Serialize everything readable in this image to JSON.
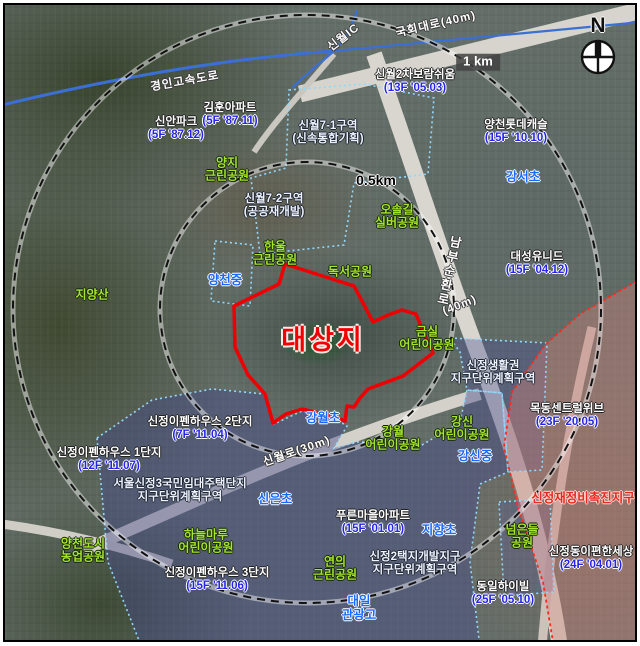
{
  "map": {
    "compass": {
      "north": "N"
    },
    "target": {
      "label": "대상지",
      "x": 318,
      "y": 335,
      "boundary_color": "#ee0000",
      "boundary_points": "283,262 352,284 371,320 386,313 400,308 414,312 422,332 431,351 401,374 366,387 358,396 352,405 345,404 343,419 334,415 321,412 300,407 284,412 271,421 263,392 256,384 246,373 233,345 232,304 277,282"
    },
    "rings": {
      "center": {
        "x": 305,
        "y": 307
      },
      "items": [
        {
          "label": "0.5km",
          "radius_px": 147,
          "label_x": 371,
          "label_y": 176,
          "style": "plain"
        },
        {
          "label": "1 km",
          "radius_px": 294,
          "label_x": 473,
          "label_y": 57,
          "style": "boxed"
        }
      ]
    },
    "colors": {
      "target_outline": "#ee0000",
      "park_text": "#a4e62e",
      "school_text": "#1769ff",
      "apartment_info_text": "#2424ea",
      "renewal_zone_text": "#e8281e",
      "district_boundary": "#8fd8ff",
      "renewal_boundary": "#ff2a1a"
    },
    "labels": [
      {
        "type": "road",
        "x": 180,
        "y": 77,
        "rot": -10,
        "lines": [
          "경인고속도로"
        ]
      },
      {
        "type": "road",
        "x": 339,
        "y": 33,
        "rot": -38,
        "lines": [
          "신월IC"
        ]
      },
      {
        "type": "road",
        "x": 431,
        "y": 20,
        "rot": -13,
        "lines": [
          "국회대로(40m)"
        ]
      },
      {
        "type": "road-v",
        "x": 443,
        "y": 266,
        "rot": 12,
        "lines": [
          "남부순환로"
        ]
      },
      {
        "type": "road",
        "x": 455,
        "y": 301,
        "rot": -22,
        "lines": [
          "(40m)"
        ]
      },
      {
        "type": "road",
        "x": 292,
        "y": 447,
        "rot": -19,
        "lines": [
          "신월로(30m)"
        ]
      },
      {
        "type": "school",
        "x": 220,
        "y": 275,
        "lines": [
          "양천중"
        ]
      },
      {
        "type": "school",
        "x": 518,
        "y": 172,
        "lines": [
          "강서초"
        ]
      },
      {
        "type": "school",
        "x": 318,
        "y": 413,
        "lines": [
          "강월초"
        ]
      },
      {
        "type": "school",
        "x": 270,
        "y": 494,
        "lines": [
          "신은초"
        ]
      },
      {
        "type": "school",
        "x": 434,
        "y": 525,
        "lines": [
          "지향초"
        ]
      },
      {
        "type": "school",
        "x": 470,
        "y": 451,
        "lines": [
          "강신중"
        ]
      },
      {
        "type": "school",
        "x": 354,
        "y": 603,
        "lines": [
          "대일",
          "관광고"
        ]
      },
      {
        "type": "park",
        "x": 222,
        "y": 165,
        "lines": [
          "양지",
          "근린공원"
        ]
      },
      {
        "type": "park",
        "x": 392,
        "y": 212,
        "lines": [
          "오솔길",
          "실버공원"
        ]
      },
      {
        "type": "park",
        "x": 270,
        "y": 249,
        "lines": [
          "한울",
          "근린공원"
        ]
      },
      {
        "type": "park",
        "x": 345,
        "y": 267,
        "lines": [
          "독서공원"
        ]
      },
      {
        "type": "park",
        "x": 422,
        "y": 334,
        "lines": [
          "금실",
          "어린이공원"
        ]
      },
      {
        "type": "park",
        "x": 388,
        "y": 434,
        "lines": [
          "강월",
          "어린이공원"
        ]
      },
      {
        "type": "park",
        "x": 457,
        "y": 424,
        "lines": [
          "강신",
          "어린이공원"
        ]
      },
      {
        "type": "park",
        "x": 201,
        "y": 537,
        "lines": [
          "하늘마루",
          "어린이공원"
        ]
      },
      {
        "type": "park",
        "x": 330,
        "y": 564,
        "lines": [
          "연의",
          "근린공원"
        ]
      },
      {
        "type": "park",
        "x": 517,
        "y": 532,
        "lines": [
          "넘은들",
          "공원"
        ]
      },
      {
        "type": "park",
        "x": 78,
        "y": 546,
        "lines": [
          "양천도시",
          "농업공원"
        ]
      },
      {
        "type": "park",
        "x": 87,
        "y": 290,
        "lines": [
          "지양산"
        ]
      },
      {
        "type": "apt",
        "x": 171,
        "y": 124,
        "lines": [
          "신안파크",
          "(5F '87.12)"
        ]
      },
      {
        "type": "apt",
        "x": 225,
        "y": 110,
        "lines": [
          "김훈아파트",
          "(5F '87.11)"
        ]
      },
      {
        "type": "apt",
        "x": 410,
        "y": 77,
        "lines": [
          "신월2차보람쉬움",
          "(13F '05.03)"
        ]
      },
      {
        "type": "apt",
        "x": 511,
        "y": 127,
        "lines": [
          "양천롯데캐슬",
          "(15F '10.10)"
        ]
      },
      {
        "type": "apt",
        "x": 532,
        "y": 259,
        "lines": [
          "대성유니드",
          "(15F '04.12)"
        ]
      },
      {
        "type": "apt",
        "x": 562,
        "y": 411,
        "lines": [
          "목동센트럴위브",
          "(23F '20.05)"
        ]
      },
      {
        "type": "apt",
        "x": 586,
        "y": 554,
        "lines": [
          "신정동이편한세상",
          "(24F '04.01)"
        ]
      },
      {
        "type": "apt",
        "x": 498,
        "y": 589,
        "lines": [
          "동일하이빌",
          "(25F '05.10)"
        ]
      },
      {
        "type": "apt",
        "x": 195,
        "y": 424,
        "lines": [
          "신정이펜하우스 2단지",
          "(7F '11.04)"
        ]
      },
      {
        "type": "apt",
        "x": 104,
        "y": 455,
        "lines": [
          "신정이펜하우스 1단지",
          "(12F '11.07)"
        ]
      },
      {
        "type": "apt",
        "x": 212,
        "y": 575,
        "lines": [
          "신정이펜하우스 3단지",
          "(15F '11.06)"
        ]
      },
      {
        "type": "apt",
        "x": 368,
        "y": 518,
        "lines": [
          "푸른마을아파트",
          "(15F '01.01)"
        ]
      },
      {
        "type": "zone",
        "x": 323,
        "y": 128,
        "lines": [
          "신월7-1구역",
          "(신속통합기획)"
        ]
      },
      {
        "type": "zone",
        "x": 269,
        "y": 201,
        "lines": [
          "신월7-2구역",
          "(공공재개발)"
        ]
      },
      {
        "type": "zone",
        "x": 488,
        "y": 368,
        "lines": [
          "신정생활권",
          "지구단위계획구역"
        ]
      },
      {
        "type": "zone",
        "x": 175,
        "y": 486,
        "lines": [
          "서울신정3국민임대주택단지",
          "지구단위계획구역"
        ]
      },
      {
        "type": "zone",
        "x": 410,
        "y": 559,
        "lines": [
          "신정2택지개발지구",
          "지구단위계획구역"
        ]
      },
      {
        "type": "redzone",
        "x": 578,
        "y": 493,
        "lines": [
          "신정재정비촉진지구"
        ]
      }
    ]
  }
}
